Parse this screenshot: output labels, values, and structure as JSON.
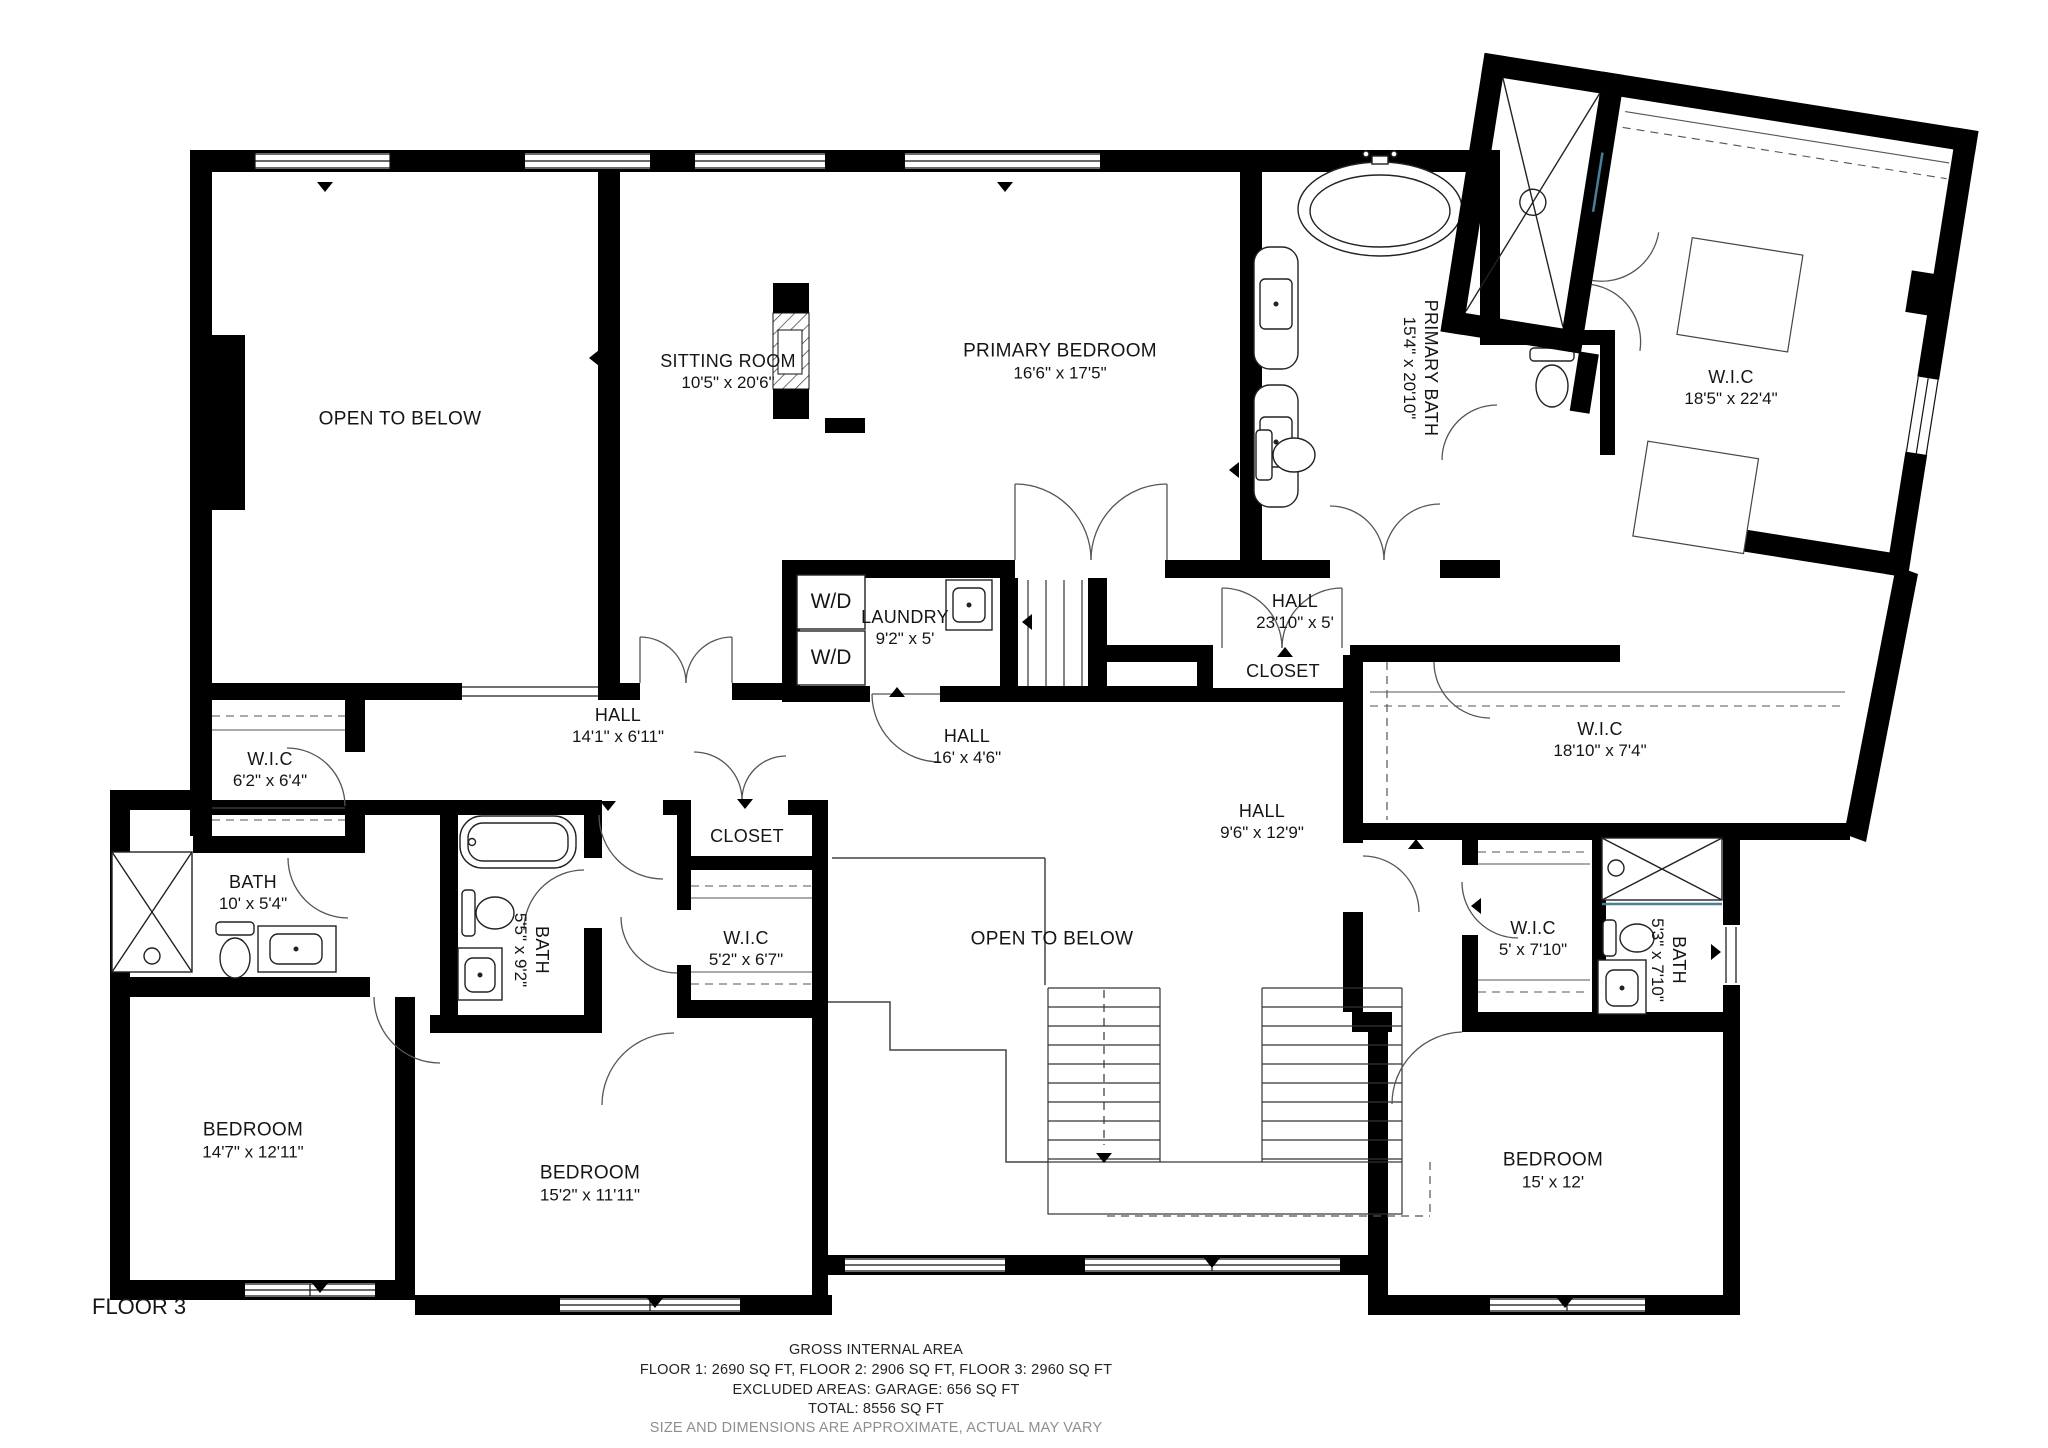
{
  "floor_label": "FLOOR 3",
  "rooms": {
    "open_below_top": {
      "label": "OPEN TO BELOW",
      "dims": ""
    },
    "sitting": {
      "label": "SITTING ROOM",
      "dims": "10'5\" x 20'6\""
    },
    "primary_bedroom": {
      "label": "PRIMARY BEDROOM",
      "dims": "16'6\" x 17'5\""
    },
    "primary_bath": {
      "label": "PRIMARY BATH",
      "dims": "15'4\" x 20'10\""
    },
    "wic_primary": {
      "label": "W.I.C",
      "dims": "18'5\" x 22'4\""
    },
    "laundry": {
      "label": "LAUNDRY",
      "dims": "9'2\" x 5'"
    },
    "hall_upper": {
      "label": "HALL",
      "dims": "23'10\" x 5'"
    },
    "closet_upper": {
      "label": "CLOSET",
      "dims": ""
    },
    "hall_14": {
      "label": "HALL",
      "dims": "14'1\" x 6'11\""
    },
    "hall_16": {
      "label": "HALL",
      "dims": "16' x 4'6\""
    },
    "wic_left": {
      "label": "W.I.C",
      "dims": "6'2\" x 6'4\""
    },
    "bath_left": {
      "label": "BATH",
      "dims": "10' x 5'4\""
    },
    "bath_mid": {
      "label": "BATH",
      "dims": "5'5\" x 9'2\""
    },
    "closet_mid": {
      "label": "CLOSET",
      "dims": ""
    },
    "wic_mid": {
      "label": "W.I.C",
      "dims": "5'2\" x 6'7\""
    },
    "hall_9": {
      "label": "HALL",
      "dims": "9'6\" x 12'9\""
    },
    "open_below_center": {
      "label": "OPEN TO BELOW",
      "dims": ""
    },
    "wic_corridor": {
      "label": "W.I.C",
      "dims": "18'10\" x 7'4\""
    },
    "wic_right": {
      "label": "W.I.C",
      "dims": "5' x 7'10\""
    },
    "bath_right": {
      "label": "BATH",
      "dims": "5'3\" x 7'10\""
    },
    "bedroom_left": {
      "label": "BEDROOM",
      "dims": "14'7\" x 12'11\""
    },
    "bedroom_mid": {
      "label": "BEDROOM",
      "dims": "15'2\" x 11'11\""
    },
    "bedroom_right": {
      "label": "BEDROOM",
      "dims": "15' x 12'"
    }
  },
  "fixtures": {
    "washer_dryer": "W/D"
  },
  "footer": {
    "line1": "GROSS INTERNAL AREA",
    "line2": "FLOOR 1: 2690 SQ FT, FLOOR 2: 2906 SQ FT, FLOOR 3: 2960 SQ FT",
    "line3": "EXCLUDED AREAS: GARAGE: 656 SQ FT",
    "line4": "TOTAL: 8556 SQ FT",
    "line5": "SIZE AND DIMENSIONS ARE APPROXIMATE, ACTUAL MAY VARY"
  },
  "colors": {
    "wall": "#000000",
    "background": "#ffffff",
    "text": "#151515",
    "muted_text": "#8f8f8f",
    "glass_accent": "#4a7f96"
  }
}
